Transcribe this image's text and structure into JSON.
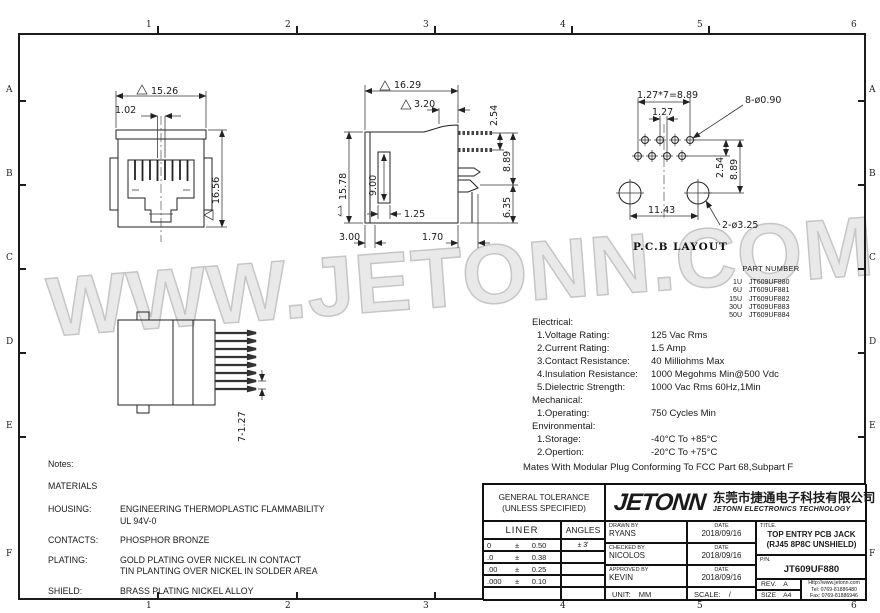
{
  "frame": {
    "cols": [
      "1",
      "2",
      "3",
      "4",
      "5",
      "6"
    ],
    "rows": [
      "A",
      "B",
      "C",
      "D",
      "E",
      "F"
    ]
  },
  "watermark": "WWW.JETONN.COM",
  "views": {
    "front": {
      "dim_width": "15.26",
      "dim_pin": "1.02",
      "dim_height": "16.56"
    },
    "side": {
      "dim_width": "16.29",
      "dim_top": "3.20",
      "dim_pin_gap": "2.54",
      "dim_height": "15.78",
      "dim_slot_depth": "9.00",
      "dim_slot_width": "1.25",
      "dim_pin_span": "8.89",
      "dim_peg": "6.35",
      "dim_plate": "3.00",
      "dim_peg_width": "1.70"
    },
    "pcb": {
      "caption": "P.C.B LAYOUT",
      "dim_span": "1.27*7=8.89",
      "dim_pitch": "1.27",
      "dim_small_holes": "8-ø0.90",
      "dim_row_gap": "2.54",
      "dim_rows_span": "8.89",
      "dim_big_pitch": "11.43",
      "dim_big_holes": "2-ø3.25"
    },
    "bottom": {
      "dim_pins": "7-1.27"
    }
  },
  "part_number": {
    "title": "PART NUMBER",
    "rows": [
      {
        "qty": "1U",
        "pn": "JT609UF880"
      },
      {
        "qty": "6U",
        "pn": "JT609UF881"
      },
      {
        "qty": "15U",
        "pn": "JT609UF882"
      },
      {
        "qty": "30U",
        "pn": "JT609UF883"
      },
      {
        "qty": "50U",
        "pn": "JT609UF884"
      }
    ]
  },
  "specs": {
    "lines": [
      {
        "label": "Electrical:",
        "value": ""
      },
      {
        "label": "1.Voltage Rating:",
        "value": "125 Vac Rms"
      },
      {
        "label": "2.Current Rating:",
        "value": "1.5 Amp"
      },
      {
        "label": "3.Contact Resistance:",
        "value": "40 Milliohms Max"
      },
      {
        "label": "4.Insulation Resistance:",
        "value": "1000 Megohms Min@500 Vdc"
      },
      {
        "label": "5.Dielectric Strength:",
        "value": "1000 Vac Rms 60Hz,1Min"
      },
      {
        "label": "Mechanical:",
        "value": ""
      },
      {
        "label": "1.Operating:",
        "value": "750 Cycles Min"
      },
      {
        "label": "Environmental:",
        "value": ""
      },
      {
        "label": "1.Storage:",
        "value": "-40°C To +85°C"
      },
      {
        "label": "2.Opertion:",
        "value": "-20°C To +75°C"
      }
    ],
    "footer": "Mates With Modular Plug Conforming To FCC Part 68,Subpart F"
  },
  "notes": {
    "title": "Notes:",
    "subtitle": "MATERIALS",
    "rows": [
      {
        "label": "HOUSING:",
        "line1": "ENGINEERING THERMOPLASTIC FLAMMABILITY",
        "line2": "UL 94V-0"
      },
      {
        "label": "CONTACTS:",
        "line1": "PHOSPHOR BRONZE",
        "line2": ""
      },
      {
        "label": "PLATING:",
        "line1": "GOLD PLATING OVER NICKEL IN CONTACT",
        "line2": "TIN PLANTING OVER NICKEL IN SOLDER AREA"
      },
      {
        "label": "SHIELD:",
        "line1": "BRASS PLATING NICKEL ALLOY",
        "line2": ""
      }
    ]
  },
  "title_block": {
    "tolerance": {
      "title_line1": "GENERAL TOLERANCE",
      "title_line2": "(UNLESS SPECIFIED)",
      "col_liner": "LINER",
      "col_angles": "ANGLES",
      "rows": [
        {
          "d": "0",
          "pm": "±",
          "v": "0.50",
          "a": "± 3'"
        },
        {
          "d": ".0",
          "pm": "±",
          "v": "0.38",
          "a": ""
        },
        {
          "d": ".00",
          "pm": "±",
          "v": "0.25",
          "a": ""
        },
        {
          "d": ".000",
          "pm": "±",
          "v": "0.10",
          "a": ""
        }
      ]
    },
    "company": {
      "logo": "JETONN",
      "cn": "东莞市捷通电子科技有限公司",
      "en": "JETONN ELECTRONICS TECHNOLOGY"
    },
    "signoff": [
      {
        "role": "DRAWN BY",
        "name": "RYANS",
        "date_label": "DATE",
        "date": "2018/09/16"
      },
      {
        "role": "CHECKED BY",
        "name": "NICOLOS",
        "date_label": "DATE",
        "date": "2018/09/16"
      },
      {
        "role": "APPROVED BY",
        "name": "KEVIN",
        "date_label": "DATE",
        "date": "2018/09/16"
      }
    ],
    "unit_label": "UNIT:",
    "unit": "MM",
    "scale_label": "SCALE:",
    "scale": "/",
    "title_label": "TITLE.",
    "title_line1": "TOP ENTRY PCB JACK",
    "title_line2": "(RJ45 8P8C UNSHIELD)",
    "pn_label": "P/N.",
    "pn": "JT609UF880",
    "rev_label": "REV.",
    "rev": "A",
    "size_label": "SIZE",
    "size": "A4",
    "web": "Http://www.jetonn.com",
    "tel": "Tel: 0769-81886480",
    "fax": "Fax: 0769-81886946"
  }
}
